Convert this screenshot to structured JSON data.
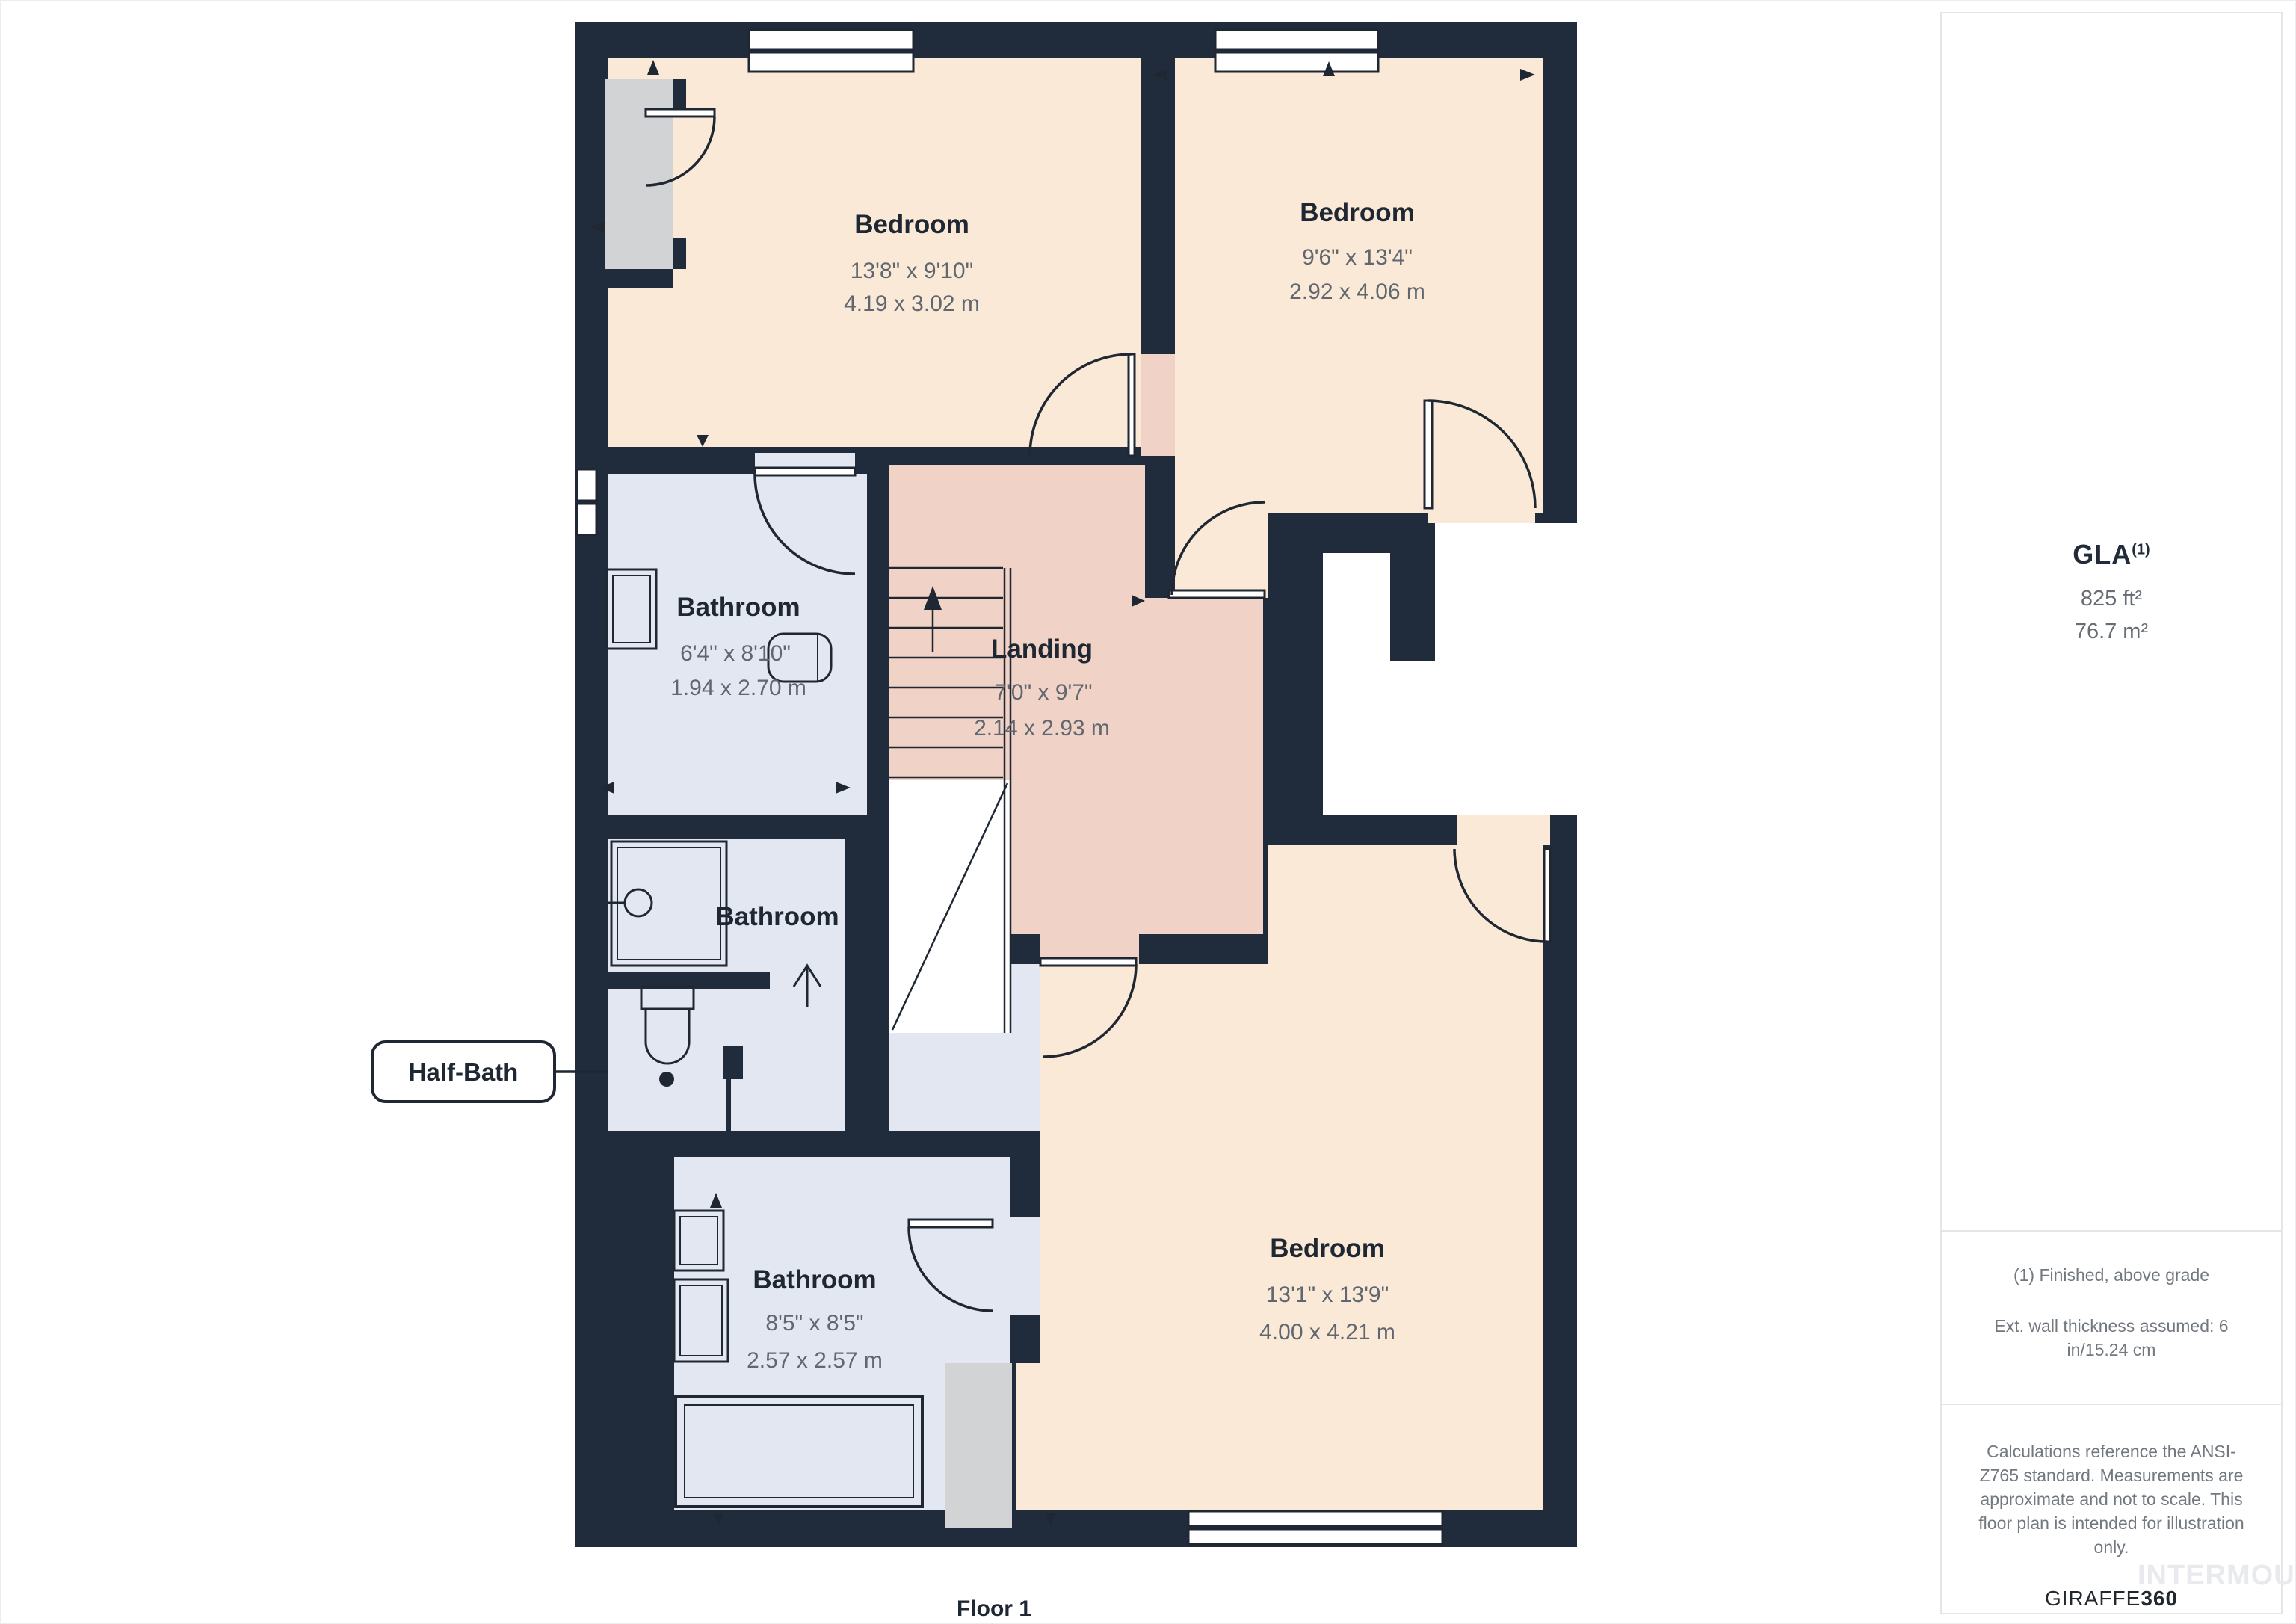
{
  "floor": {
    "label": "Floor 1"
  },
  "rooms": {
    "bedroom_tl": {
      "name": "Bedroom",
      "dims_ft": "13'8\" x 9'10\"",
      "dims_m": "4.19 x 3.02 m"
    },
    "bedroom_tr": {
      "name": "Bedroom",
      "dims_ft": "9'6\" x 13'4\"",
      "dims_m": "2.92 x 4.06 m"
    },
    "bathroom_top": {
      "name": "Bathroom",
      "dims_ft": "6'4\" x 8'10\"",
      "dims_m": "1.94 x 2.70 m"
    },
    "landing": {
      "name": "Landing",
      "dims_ft": "7'0\" x 9'7\"",
      "dims_m": "2.14 x 2.93 m"
    },
    "bathroom_mid": {
      "name": "Bathroom"
    },
    "half_bath": {
      "label": "Half-Bath"
    },
    "bathroom_bottom": {
      "name": "Bathroom",
      "dims_ft": "8'5\" x 8'5\"",
      "dims_m": "2.57 x 2.57 m"
    },
    "bedroom_br": {
      "name": "Bedroom",
      "dims_ft": "13'1\" x 13'9\"",
      "dims_m": "4.00 x 4.21 m"
    }
  },
  "sidebar": {
    "gla_label": "GLA",
    "gla_superscript": "(1)",
    "gla_ft": "825 ft²",
    "gla_m": "76.7 m²",
    "note_finished": "(1) Finished, above grade",
    "note_wall": "Ext. wall thickness assumed: 6 in/15.24 cm",
    "disclaimer": "Calculations reference the ANSI-Z765 standard. Measurements are approximate and not to scale. This floor plan is intended for illustration only.",
    "brand_name": "GIRAFFE",
    "brand_suffix": "360",
    "watermark": "INTERMOUNTAIN"
  },
  "colors": {
    "wall": "#202B3B",
    "bedroom_fill": "#FBE9D7",
    "landing_fill": "#F0D3C6",
    "bathroom_fill": "#E2E7F1",
    "closet_fill": "#D2D3D4",
    "dim_text": "#60676F",
    "name_text": "#1F2733"
  }
}
